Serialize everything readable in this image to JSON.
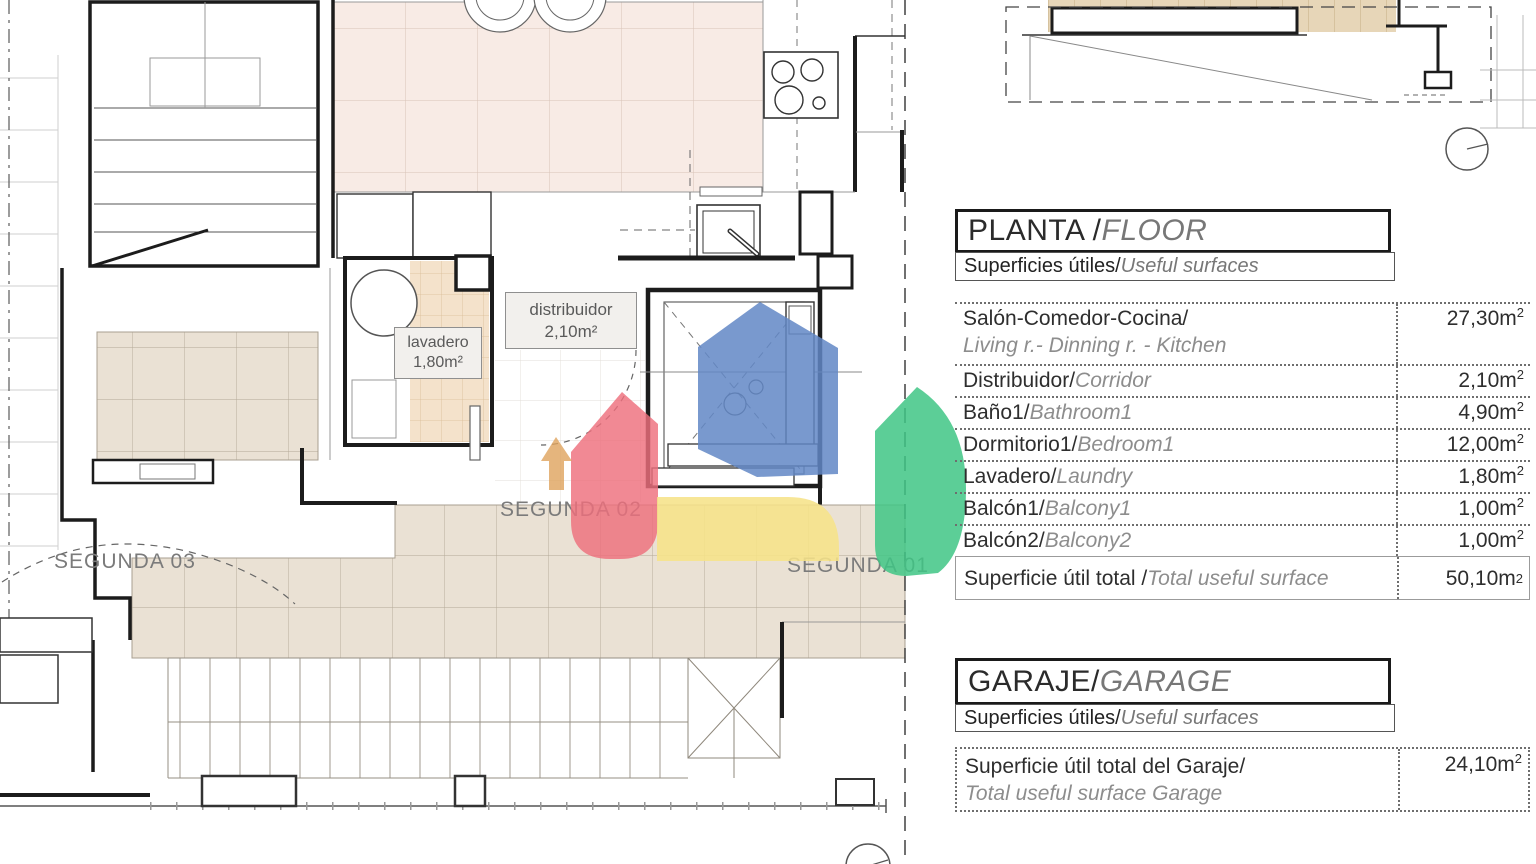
{
  "plan": {
    "room_labels": [
      {
        "name": "lavadero",
        "area": "1,80m²"
      },
      {
        "name": "distribuidor",
        "area": "2,10m²"
      }
    ],
    "zone_labels": [
      "SEGUNDA 03",
      "SEGUNDA 02",
      "SEGUNDA 01"
    ]
  },
  "floor_table": {
    "title_es": "PLANTA / ",
    "title_en": "FLOOR",
    "subtitle_es": "Superficies útiles/",
    "subtitle_en": "Useful surfaces",
    "rows": [
      {
        "es": "Salón-Comedor-Cocina/",
        "en": "Living r.- Dinning r. - Kitchen",
        "value": "27,30m"
      },
      {
        "es": "Distribuidor/",
        "en": "Corridor",
        "value": "2,10m"
      },
      {
        "es": "Baño1/",
        "en": "Bathroom1",
        "value": "4,90m"
      },
      {
        "es": "Dormitorio1/",
        "en": "Bedroom1",
        "value": "12,00m"
      },
      {
        "es": "Lavadero/",
        "en": "Laundry",
        "value": "1,80m"
      },
      {
        "es": "Balcón1/",
        "en": "Balcony1",
        "value": "1,00m"
      },
      {
        "es": "Balcón2/",
        "en": "Balcony2",
        "value": "1,00m"
      }
    ],
    "total": {
      "es": "Superficie útil total / ",
      "en": "Total useful surface",
      "value": "50,10m"
    }
  },
  "garage_table": {
    "title_es": "GARAJE/",
    "title_en": "GARAGE",
    "subtitle_es": "Superficies útiles/",
    "subtitle_en": "Useful surfaces",
    "total": {
      "es": "Superficie útil total del Garaje/",
      "en": "Total useful surface Garage",
      "value": "24,10m"
    }
  },
  "units": {
    "sup": "2"
  },
  "colors": {
    "logo_blue": "#6187c5",
    "logo_red": "#ee6f7d",
    "logo_yellow": "#f6e289",
    "logo_green": "#3fc585",
    "arrow_orange": "#dfa35c",
    "tile_pink": "#f8ebe5",
    "tile_beige": "#eae1d4",
    "tile_tan": "#f4e2cb",
    "wall": "#1c1c1c"
  }
}
